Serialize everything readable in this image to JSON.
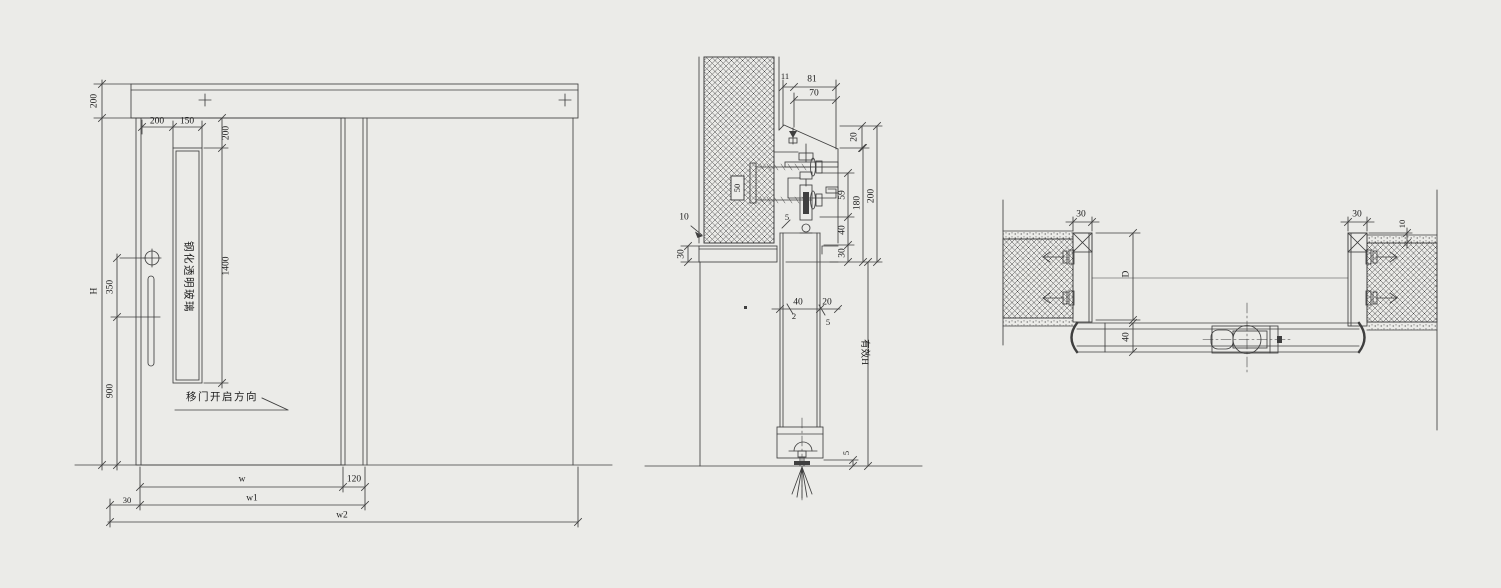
{
  "canvas": {
    "background": "#ebebe8",
    "line_color": "#3f3f3f"
  },
  "elevation": {
    "dims": {
      "header_height": "200",
      "overall_height": "H",
      "lock_spacing": "350",
      "handle_base_height": "900",
      "stile_width": "200",
      "glass_width": "150",
      "glass_top_offset": "200",
      "glass_height": "1400",
      "leaf_width": "w",
      "overlap": "120",
      "edge_overlap": "30",
      "width_w1": "w1",
      "width_w2": "w2"
    },
    "labels": {
      "glass": "钢化透明玻璃",
      "open_direction": "移门开启方向"
    }
  },
  "section": {
    "dims": {
      "cover_lip": "11",
      "cover_total": "81",
      "cover_width": "70",
      "cover_height": "20",
      "hanger_height": "59",
      "roller_gap": "40",
      "track_height": "30",
      "assembly_inner": "180",
      "assembly_total": "200",
      "effective_height": "有效H",
      "anchor_depth": "50",
      "wall_gap": "10",
      "soffit_height": "30",
      "top_gap": "5",
      "leaf_thickness": "40",
      "rear_gap": "20",
      "glass_thickness": "2",
      "seal_gap": "5",
      "floor_clearance": "5"
    }
  },
  "plan": {
    "dims": {
      "left_jamb_width": "30",
      "right_jamb_width": "30",
      "jamb_projection": "10",
      "pocket_depth": "D",
      "leaf_thickness": "40"
    }
  }
}
